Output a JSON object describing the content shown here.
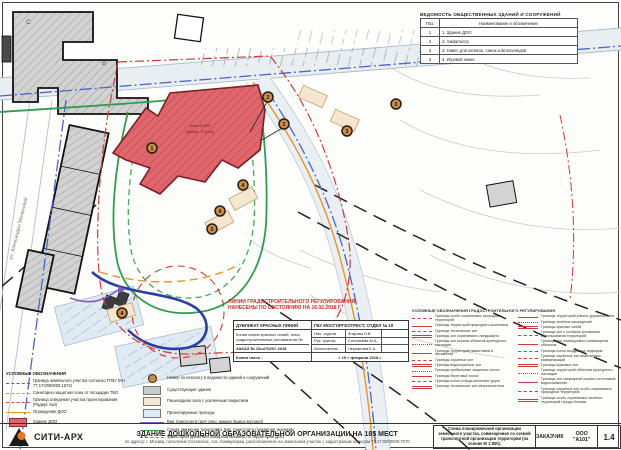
{
  "map": {
    "street_label": "ул. Александры Монаховой",
    "letter_c": "С",
    "letter_b": "В",
    "elev_line1": "отм ±0.000",
    "elev_line2": "(абсол. 179,40)",
    "markers": [
      "1",
      "2",
      "2",
      "3",
      "3",
      "4",
      "4",
      "3",
      "4"
    ]
  },
  "buildings_table": {
    "title": "ВЕДОМОСТЬ ОБЩЕСТВЕННЫХ ЗДАНИЙ И СООРУЖЕНИЙ",
    "col_pos": "Поз.",
    "col_name": "Наименование и обозначение",
    "rows": [
      {
        "pos": "1",
        "name": "1. Здание ДОО"
      },
      {
        "pos": "2",
        "name": "2. Амфитеатр"
      },
      {
        "pos": "3",
        "name": "3. Навес для колясок, санок и велосипедов"
      },
      {
        "pos": "4",
        "name": "4. Игровой навес"
      }
    ]
  },
  "red_note": {
    "line1": "ЛИНИИ ГРАДОСТРОИТЕЛЬНОГО РЕГУЛИРОВАНИЯ",
    "line2": "НАНЕСЕНЫ ПО СОСТОЯНИЮ НА 16.02.2018 Г."
  },
  "stamp": {
    "dup_title": "ДУБЛИКАТ КРАСНЫХ ЛИНИЙ",
    "org": "ГБУ МОСГОРГЕОТРЕСТ, ОТДЕЛ № 10",
    "note": "Копии писем красных линий, иных градостроительных регламентов №",
    "order": "ЗАКАЗ № 10ы/7б207-2018",
    "copy": "Копия часть -",
    "roles": [
      {
        "role": "Нач. отдела",
        "name": "Жарова Н.В."
      },
      {
        "role": "Рук. группы",
        "name": "Соловьёва М.А."
      },
      {
        "role": "Исполнитель",
        "name": "Черканова Е.А."
      }
    ],
    "date": "« 19 » февраля 2018 г."
  },
  "legend_left": {
    "title": "УСЛОВНЫЕ ОБОЗНАЧЕНИЯ",
    "items": [
      "Граница земельного участка согласно ГПЗУ (КН 77:17:0000000:1673)",
      "Санитарно-защитная зона от площадки ТБО",
      "Граница отведения участка проектирования (Радиус №3)",
      "Ограждение ДОО",
      "Здание ДОО"
    ]
  },
  "legend_mid": {
    "items": [
      "Номер по каталогу в ведомости зданий и сооружений",
      "Существующие здания",
      "Пешеходная зона с усиленным покрытием",
      "Проектируемые проезды",
      "Вид транспорта (для спец. машин (вывоз мусора))",
      "Схема движения транспорта. Вид транспорта (пожарная техника)",
      "Траектория движения пожарной машины по территории ДОО"
    ]
  },
  "legend_right": {
    "title": "УСЛОВНЫЕ ОБОЗНАЧЕНИЯ ГРАДОСТРОИТЕЛЬНОГО РЕГУЛИРОВАНИЯ",
    "left": [
      "Границы особо охраняемых природных территорий",
      "Границы территорий природного комплекса",
      "Границы технических зон",
      "Границы зон охраняемого ландшафта",
      "Границы зон охраны объектов культурного наследия",
      "Границы территорий памятников и ансамблей",
      "Границы охранных зон",
      "Границы водоохранных зон",
      "Границы прибрежных защитных полос",
      "Границы береговых полос",
      "Границы полос отвода железных дорог",
      "Границы технических зон метрополитена"
    ],
    "right": [
      "Границы территорий улично-дорожной сети",
      "Границы зелёных насаждений",
      "Границы красных линий",
      "Границы зон с особыми условиями использования территорий",
      "Границы зон планируемого размещения объектов",
      "Границы полос воздушных подходов",
      "Границы охранных зон инженерных коммуникаций",
      "Границы шумовых зон",
      "Границы территорий объектов культурного наследия",
      "Границы зон санитарной охраны источников водоснабжения",
      "Границы охранных зон особо охраняемых природных территорий",
      "Границы особо охраняемых зелёных территорий города Москвы"
    ]
  },
  "footer": {
    "logo": "СИТИ-АРХ",
    "title": "ЗДАНИЕ ДОШКОЛЬНОЙ ОБРАЗОВАТЕЛЬНОЙ ОРГАНИЗАЦИИ НА 185 МЕСТ",
    "subtitle": "по адресу: г. Москва, поселение Сосенское, пос. Коммунарка, расположенное на земельном участке с кадастровым номером 77:17:0000000:7070",
    "scheme": "Схема планировочной организации земельного участка, совмещенная со схемой транспортной организации территории (на основе М 1:500).",
    "customer_label": "ЗАКАЗЧИК",
    "customer_name": "ООО \"А101\"",
    "sheet_no": "1.4"
  },
  "colors": {
    "accent_red": "#cc3b35",
    "site_red": "#e0666d",
    "green": "#2f9e4c",
    "blue": "#4f64c8",
    "orange": "#e8932c"
  }
}
